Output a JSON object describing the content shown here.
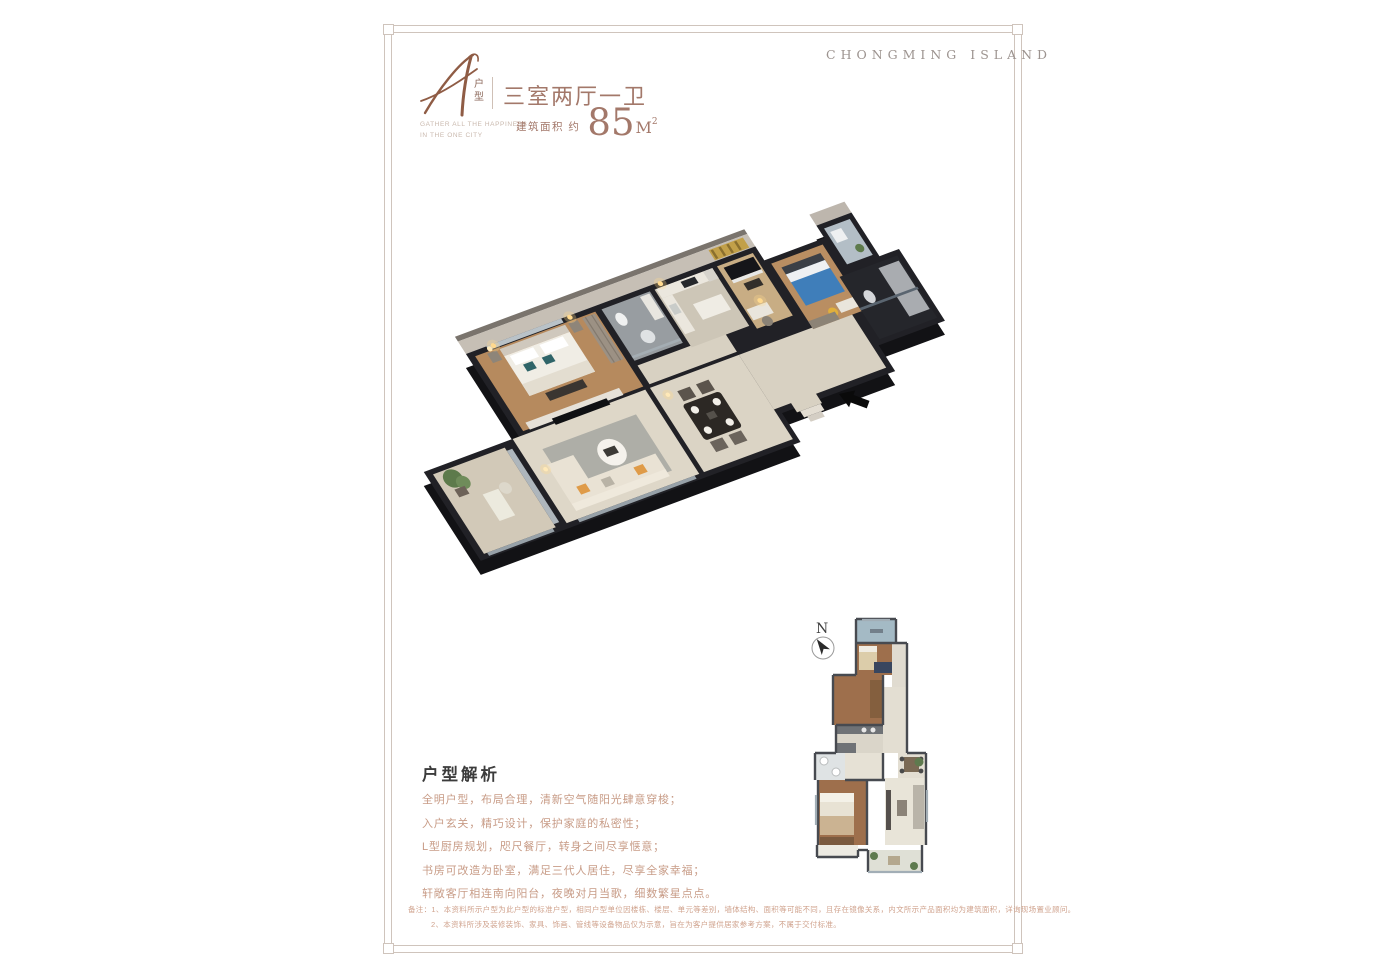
{
  "page": {
    "background": "#ffffff",
    "frame_color": "#cfc4bc"
  },
  "header": {
    "type_letter": "A",
    "type_label_char1": "户",
    "type_label_char2": "型",
    "title": "三室两厅一卫",
    "tagline_line1": "GATHER ALL THE HAPPINESS",
    "tagline_line2": "IN THE ONE CITY",
    "area_prefix": "建筑面积 约",
    "area_value": "85",
    "area_unit": "M",
    "area_sup": "2",
    "brand": "CHONGMING ISLAND"
  },
  "floorplan": {
    "render_type": "isometric-3d-apartment-render",
    "entry_marker": "black-arrow-pointing-to-entry",
    "mini_plan_north_label": "N"
  },
  "analysis": {
    "heading": "户型解析",
    "lines": [
      "全明户型，布局合理，清新空气随阳光肆意穿梭；",
      "入户玄关，精巧设计，保护家庭的私密性；",
      "L型厨房规划，咫尺餐厅，转身之间尽享惬意；",
      "书房可改造为卧室，满足三代人居住，尽享全家幸福；",
      "轩敞客厅相连南向阳台，夜晚对月当歌，细数繁星点点。"
    ]
  },
  "disclaimer": {
    "line1": "备注：1、本资料所示户型为此户型的标准户型，相同户型单位因楼栋、楼层、单元等差别，墙体结构、面积等可能不同，且存在镜像关系，内文所示产品面积均为建筑面积，详询现场置业顾问。",
    "line2": "2、本资料所涉及装修装饰、家具、饰画、管线等设备物品仅为示意，旨在为客户提供居家参考方案，不属于交付标准。"
  },
  "colors": {
    "title_brown": "#a3786a",
    "script_letter": "#8f5c45",
    "brand_gray": "#9c938f",
    "heading_dark": "#3c3c3c",
    "body_salmon": "#c89c87",
    "wall_dark": "#1e1e22",
    "floor_wood": "#b68a5e",
    "floor_tile": "#ded7c8",
    "accent_orange": "#df9b48",
    "accent_blue_bed": "#3f7eba"
  }
}
